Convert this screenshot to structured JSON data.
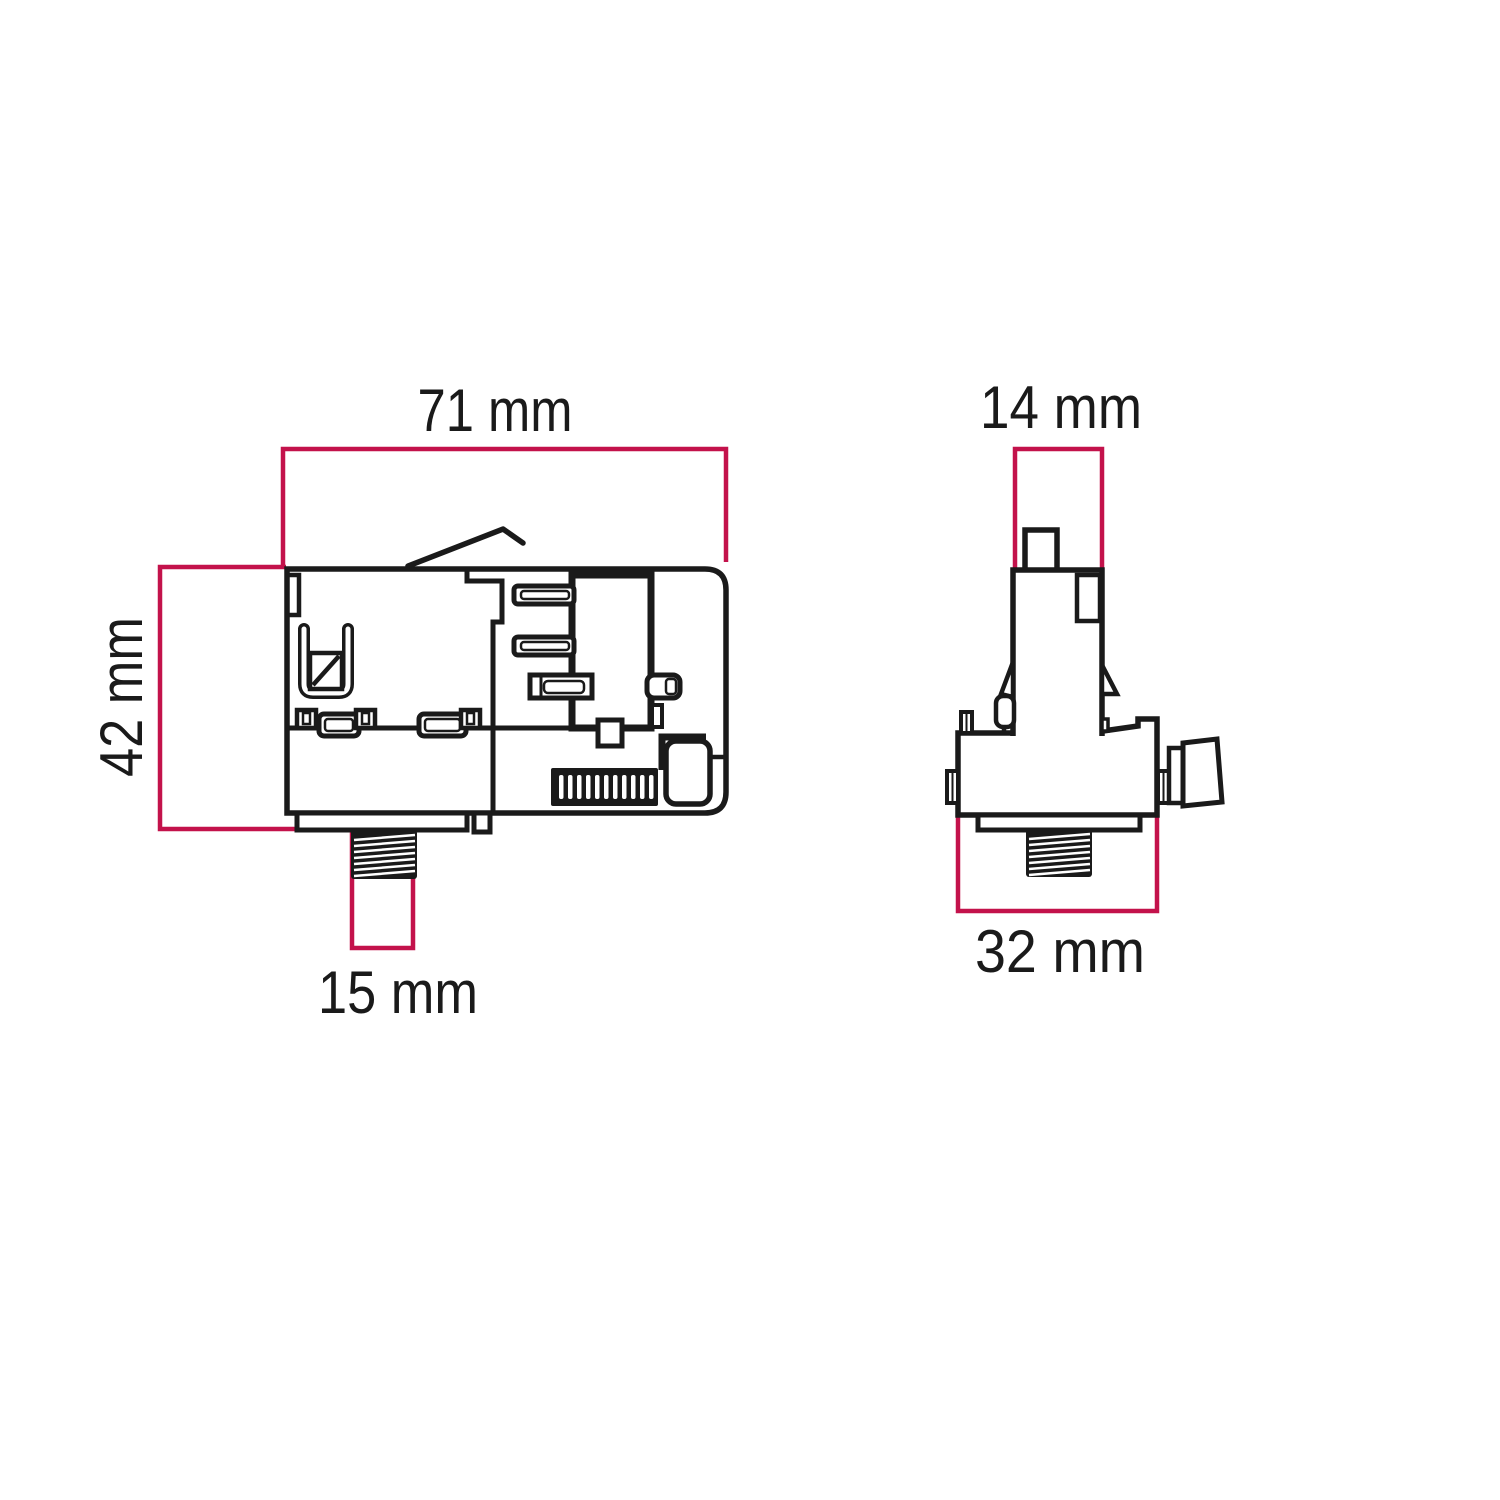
{
  "diagram": {
    "background_color": "#ffffff",
    "outline_color": "#1a1a1a",
    "dimension_line_color": "#c3124b",
    "side_view": {
      "overall_width_label": "71 mm",
      "overall_height_label": "42 mm",
      "stem_width_label": "15 mm"
    },
    "front_view": {
      "top_width_label": "14 mm",
      "base_width_label": "32 mm"
    }
  }
}
